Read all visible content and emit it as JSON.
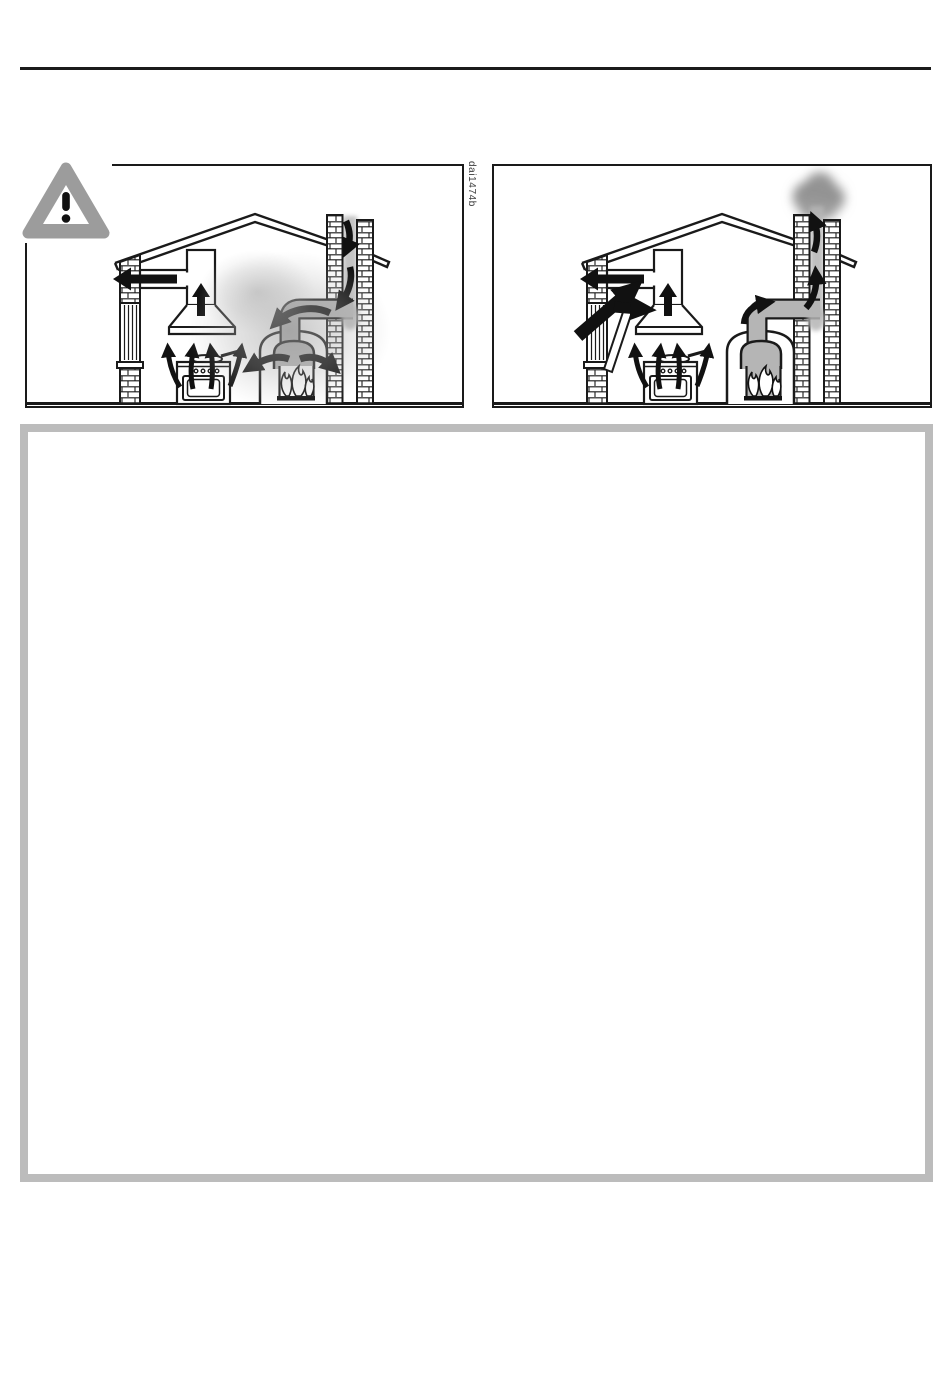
{
  "page": {
    "background": "#ffffff"
  },
  "top_rule": {
    "color": "#1b1b1b"
  },
  "figure": {
    "code_label": "dai1474b",
    "warning_icon": {
      "name": "warning-triangle-icon",
      "glyph": "!",
      "color": "#9c9c9c"
    },
    "panels": [
      {
        "name": "hood-exhaust-with-fireplace-backdraft"
      },
      {
        "name": "hood-exhaust-with-fresh-air-supply-and-chimney-draft"
      }
    ]
  },
  "colors": {
    "line": "#1a1a1a",
    "duct_smoke_gray": "#b5b5b5",
    "room_smoke_gray": "#9a9a9a",
    "chimney_smoke_gray": "#8f8f8f",
    "callout_border_gray": "#bcbcbc",
    "warning_triangle_gray": "#9c9c9c"
  },
  "callout_box": {
    "content": ""
  }
}
